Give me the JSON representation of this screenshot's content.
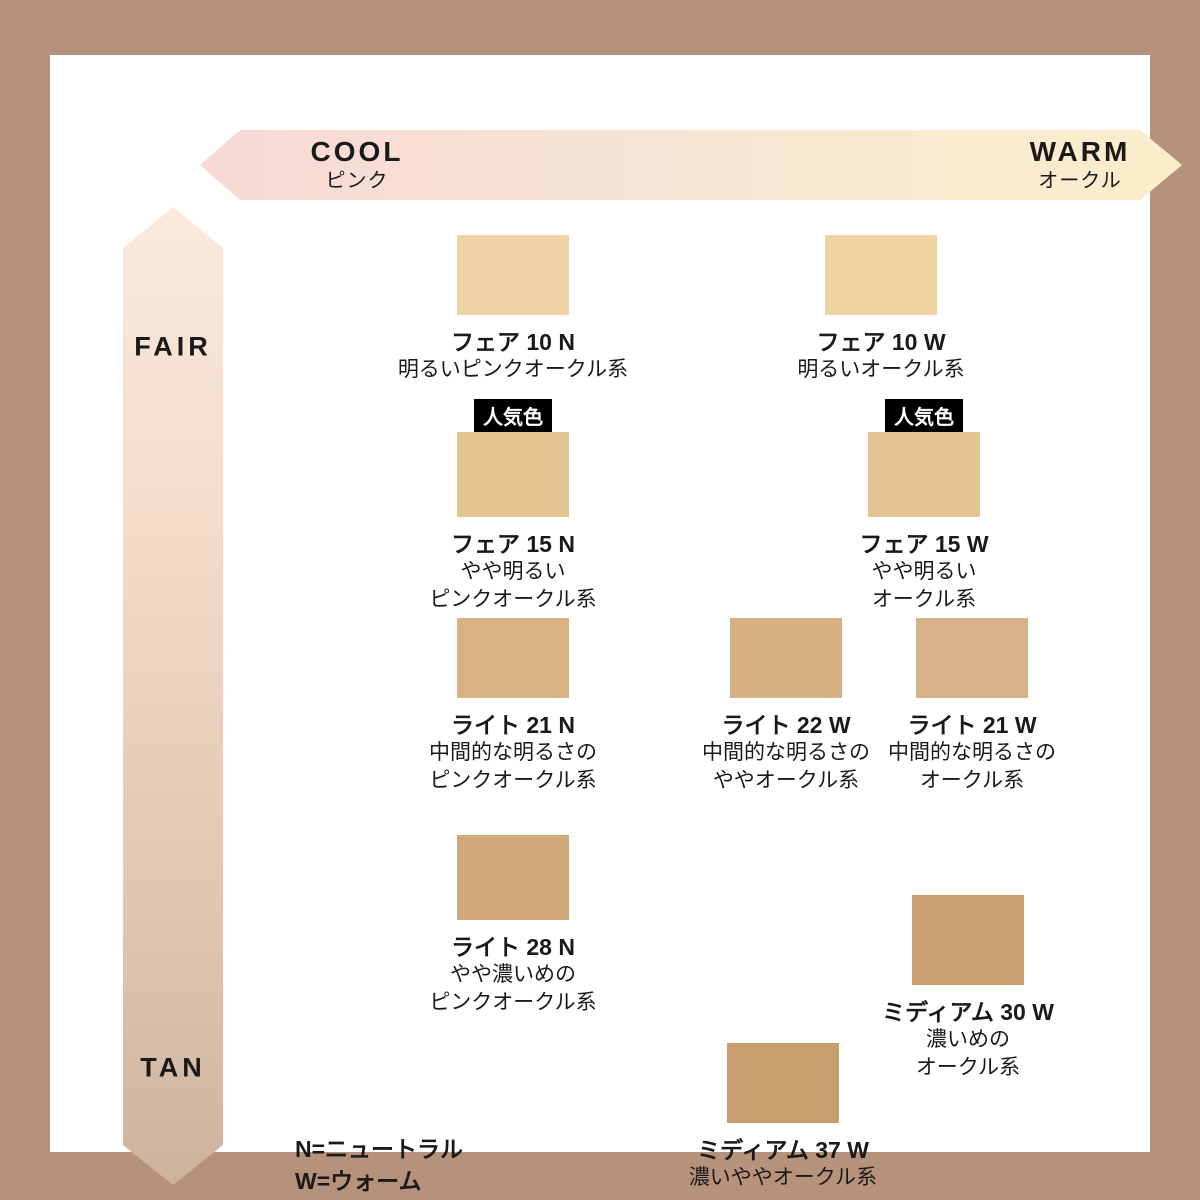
{
  "frame": {
    "border_color": "#B6927A",
    "background": "#FFFFFF"
  },
  "axes": {
    "horizontal": {
      "left_label": "COOL",
      "left_sublabel": "ピンク",
      "right_label": "WARM",
      "right_sublabel": "オークル",
      "gradient_left": "#F8D9D4",
      "gradient_right": "#FAEDCB"
    },
    "vertical": {
      "top_label": "FAIR",
      "bottom_label": "TAN",
      "gradient_top": "#FAE9DD",
      "gradient_bottom": "#CDB29E"
    }
  },
  "popular_badge_label": "人気色",
  "legend": {
    "line1": "N=ニュートラル",
    "line2": "W=ウォーム"
  },
  "shades": [
    {
      "id": "fair-10n",
      "name": "フェア 10 N",
      "desc_lines": [
        "明るいピンクオークル系"
      ],
      "swatch_color": "#EFD3A4",
      "popular": false
    },
    {
      "id": "fair-10w",
      "name": "フェア 10 W",
      "desc_lines": [
        "明るいオークル系"
      ],
      "swatch_color": "#EED2A2",
      "popular": false
    },
    {
      "id": "fair-15n",
      "name": "フェア 15 N",
      "desc_lines": [
        "やや明るい",
        "ピンクオークル系"
      ],
      "swatch_color": "#E2C48F",
      "popular": true
    },
    {
      "id": "fair-15w",
      "name": "フェア 15 W",
      "desc_lines": [
        "やや明るい",
        "オークル系"
      ],
      "swatch_color": "#E3C591",
      "popular": true
    },
    {
      "id": "light-21n",
      "name": "ライト 21 N",
      "desc_lines": [
        "中間的な明るさの",
        "ピンクオークル系"
      ],
      "swatch_color": "#D7B383",
      "popular": false
    },
    {
      "id": "light-22w",
      "name": "ライト 22 W",
      "desc_lines": [
        "中間的な明るさの",
        "ややオークル系"
      ],
      "swatch_color": "#D5B183",
      "popular": false
    },
    {
      "id": "light-21w",
      "name": "ライト 21 W",
      "desc_lines": [
        "中間的な明るさの",
        "オークル系"
      ],
      "swatch_color": "#D7B286",
      "popular": false
    },
    {
      "id": "light-28n",
      "name": "ライト 28 N",
      "desc_lines": [
        "やや濃いめの",
        "ピンクオークル系"
      ],
      "swatch_color": "#D2A97A",
      "popular": false
    },
    {
      "id": "medium-30w",
      "name": "ミディアム 30 W",
      "desc_lines": [
        "濃いめの",
        "オークル系"
      ],
      "swatch_color": "#CBA271",
      "popular": false
    },
    {
      "id": "medium-37w",
      "name": "ミディアム 37 W",
      "desc_lines": [
        "濃いややオークル系"
      ],
      "swatch_color": "#C89E6C",
      "popular": false
    }
  ]
}
